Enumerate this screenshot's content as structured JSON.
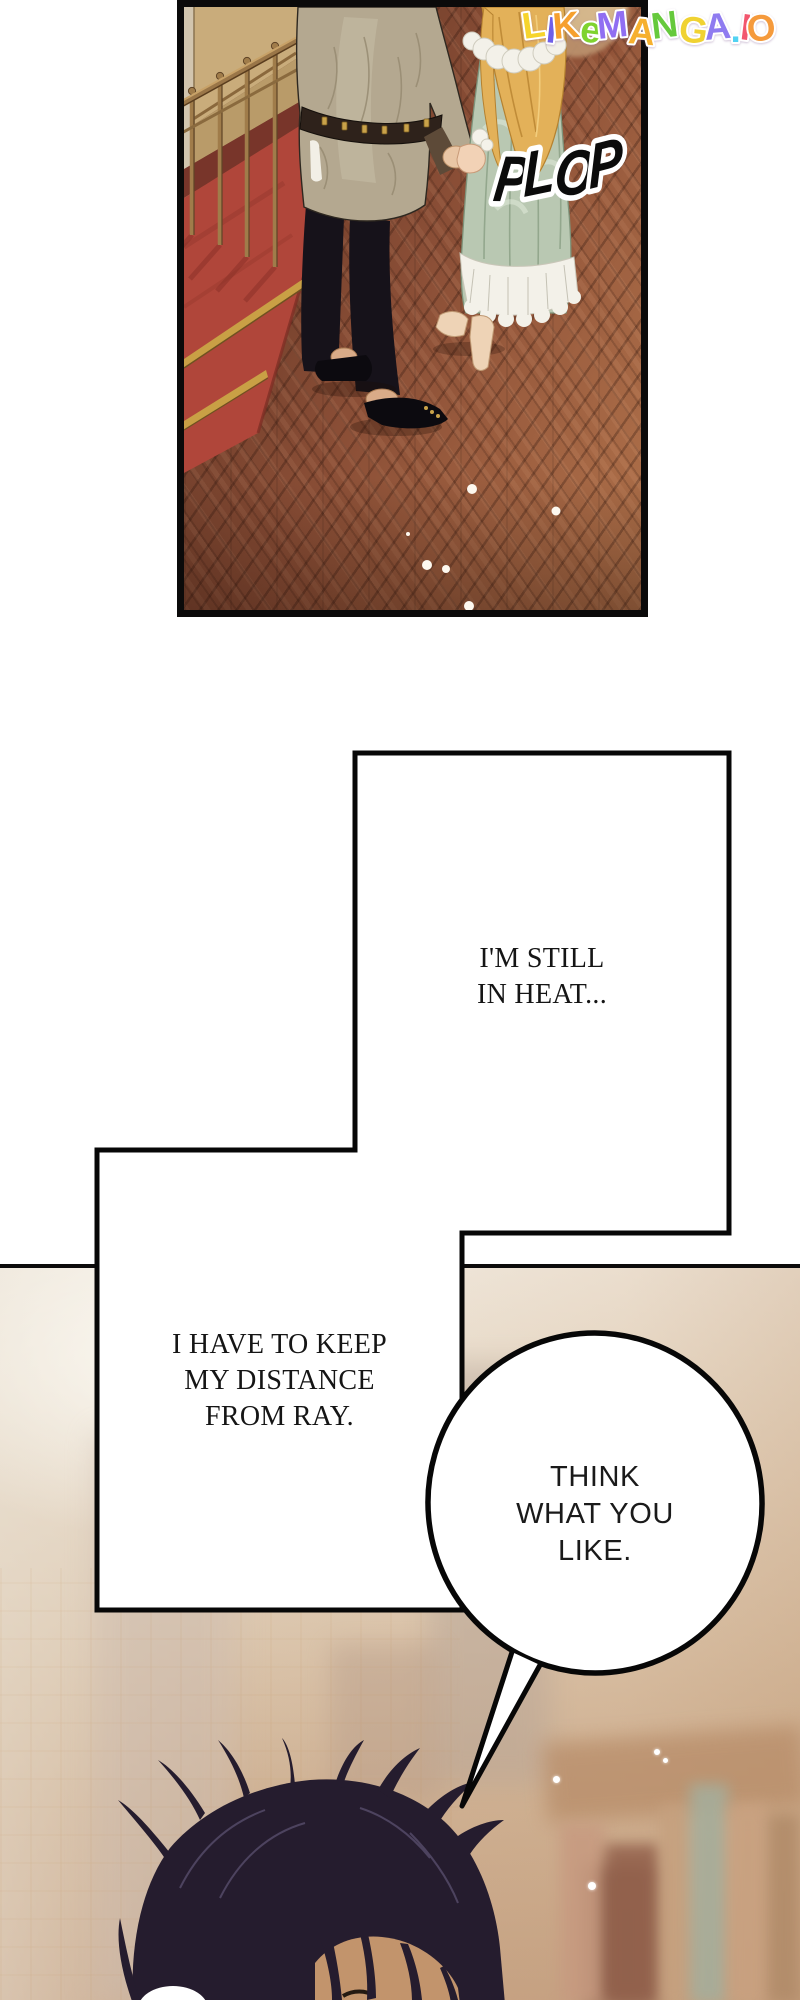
{
  "watermark": {
    "text": "LIKEMANGA.IO",
    "letters": [
      {
        "ch": "L",
        "color": "#f6d42c"
      },
      {
        "ch": "I",
        "color": "#6f5fe8"
      },
      {
        "ch": "K",
        "color": "#f6a02e"
      },
      {
        "ch": "e",
        "color": "#7fd32f"
      },
      {
        "ch": "M",
        "color": "#906ef2"
      },
      {
        "ch": "A",
        "color": "#f6b02e"
      },
      {
        "ch": "N",
        "color": "#66c93c"
      },
      {
        "ch": "G",
        "color": "#f0d232"
      },
      {
        "ch": "A",
        "color": "#8f7bf0"
      },
      {
        "ch": ".",
        "color": "#52d2f2"
      },
      {
        "ch": "I",
        "color": "#f2566e"
      },
      {
        "ch": "O",
        "color": "#f59a3c"
      }
    ]
  },
  "panel_top": {
    "sfx": "PLOP"
  },
  "thoughts": {
    "heat": {
      "lines": [
        "I'M STILL",
        "IN HEAT..."
      ]
    },
    "distance": {
      "lines": [
        "I HAVE TO KEEP",
        "MY DISTANCE",
        "FROM RAY."
      ]
    }
  },
  "speech": {
    "bubble": {
      "lines": [
        "THINK",
        "WHAT YOU",
        "LIKE."
      ]
    }
  },
  "colors": {
    "floor_wood": "#8a4e36",
    "carpet_red": "#b0463a",
    "wall_tan": "#c9ac7b",
    "jacket_greige": "#b4a890",
    "dress_sage": "#b9c8b2",
    "hair_blonde": "#e3b159",
    "hair_dark": "#251c2e",
    "haze_beige": "#e4d4c0",
    "outline_black": "#0c0b0b"
  }
}
